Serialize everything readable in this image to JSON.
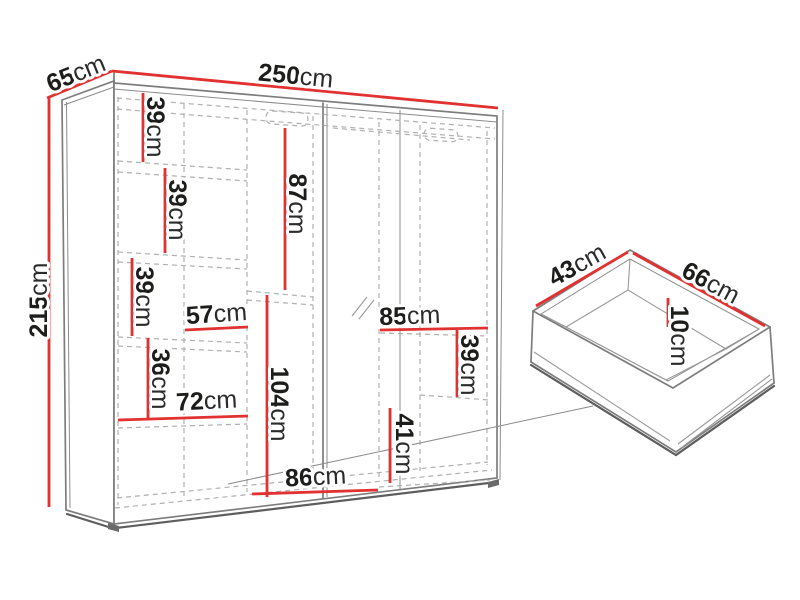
{
  "colors": {
    "dimension_red": "#e23131",
    "outline_gray": "#7d7d7d",
    "dashed_gray": "#b0b0b0",
    "label_text": "#1d1d1b",
    "background": "#ffffff"
  },
  "wardrobe": {
    "width": {
      "value": "250",
      "unit": "cm"
    },
    "depth": {
      "value": "65",
      "unit": "cm"
    },
    "height": {
      "value": "215",
      "unit": "cm"
    },
    "left_column": {
      "shelf_spacings": [
        {
          "value": "39",
          "unit": "cm"
        },
        {
          "value": "39",
          "unit": "cm"
        },
        {
          "value": "39",
          "unit": "cm"
        },
        {
          "value": "36",
          "unit": "cm"
        }
      ],
      "widths": [
        {
          "value": "57",
          "unit": "cm"
        },
        {
          "value": "72",
          "unit": "cm"
        }
      ]
    },
    "middle_column": {
      "upper_height": {
        "value": "87",
        "unit": "cm"
      },
      "lower_height": {
        "value": "104",
        "unit": "cm"
      },
      "width": {
        "value": "86",
        "unit": "cm"
      }
    },
    "right_column": {
      "width": {
        "value": "85",
        "unit": "cm"
      },
      "upper_height": {
        "value": "39",
        "unit": "cm"
      },
      "lower_height": {
        "value": "41",
        "unit": "cm"
      }
    }
  },
  "drawer": {
    "depth": {
      "value": "43",
      "unit": "cm"
    },
    "width": {
      "value": "66",
      "unit": "cm"
    },
    "height": {
      "value": "10",
      "unit": "cm"
    }
  }
}
